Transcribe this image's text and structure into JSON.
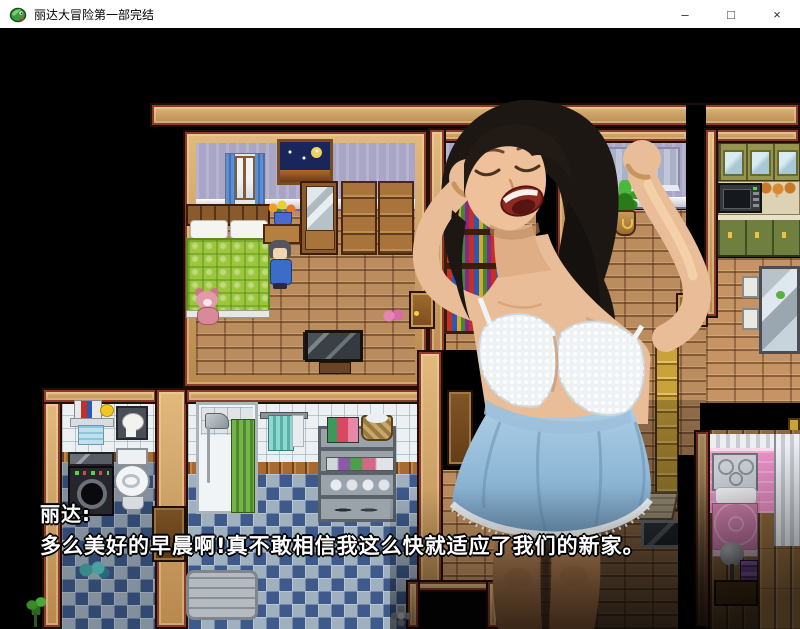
{
  "window": {
    "title": "丽达大冒险第一部完结",
    "minimize_glyph": "–",
    "maximize_glyph": "□",
    "close_glyph": "×"
  },
  "dialogue": {
    "speaker": "丽达:",
    "line": "多么美好的早晨啊!真不敢相信我这么快就适应了我们的新家。"
  },
  "colors": {
    "titlebar_bg": "#ffffff",
    "titlebar_text": "#000000",
    "scene_bg": "#000000",
    "wall_tan": "#cda268",
    "wall_accent": "#8a3a30",
    "floor_brick": "#bb8c5e",
    "bedroom_wall": "#a9a5c6",
    "bed_green": "#9cc73c",
    "bathroom_tile": "#ecf0f2",
    "bathroom_floor_dark": "#3d5a8a",
    "bathroom_floor_light": "#9fb0bf",
    "shower_curtain_green": "#63a23c",
    "pink_bed": "#d985b5",
    "nightgown_blue": "#8fb7d6",
    "dialogue_text": "#ffffff"
  }
}
